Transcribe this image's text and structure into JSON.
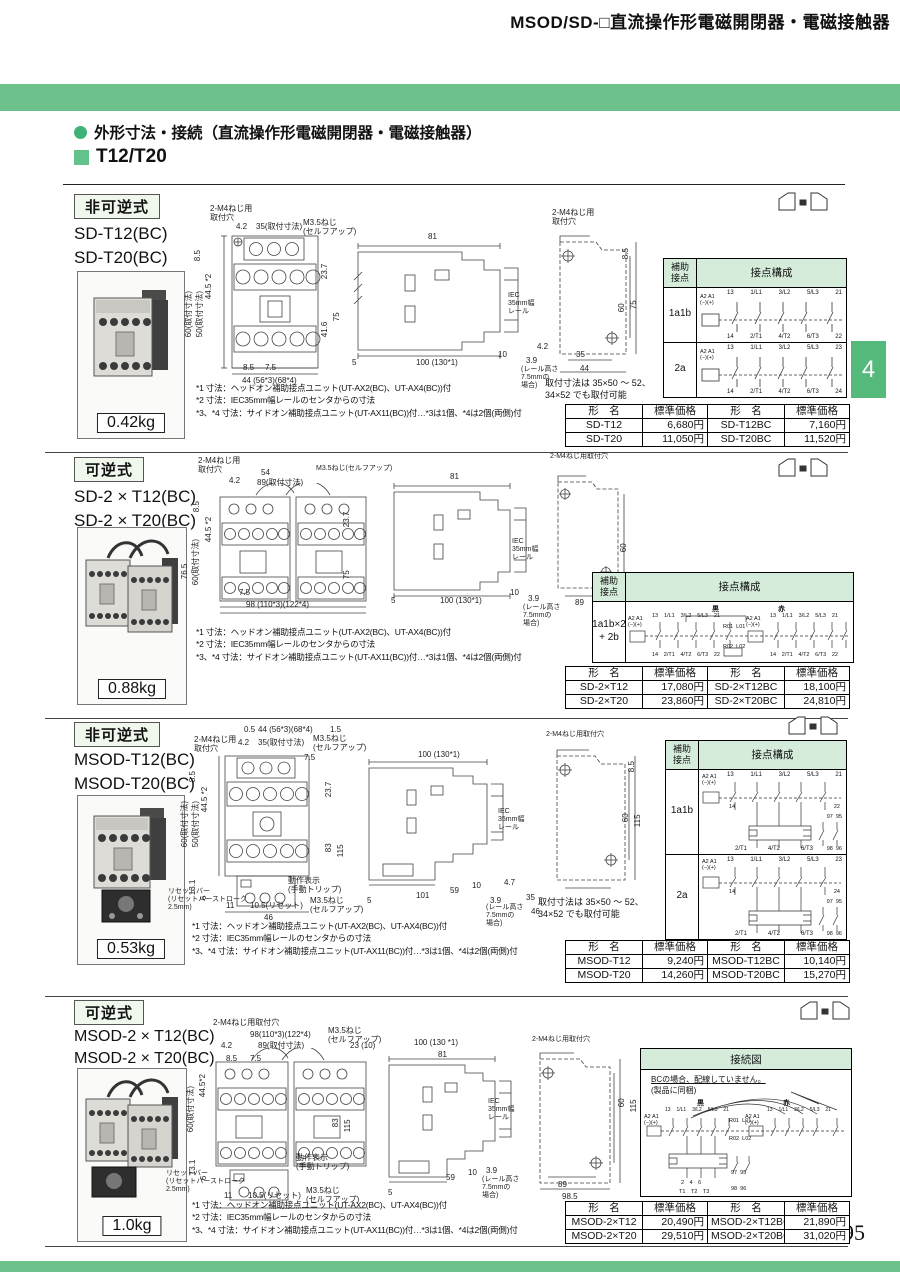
{
  "page": {
    "header_title": "MSOD/SD-□直流操作形電磁開閉器・電磁接触器",
    "section_bullet_title": "外形寸法・接続（直流操作形電磁開閉器・電磁接触器）",
    "subsection_title": "T12/T20",
    "side_tab": "4",
    "page_number": "95"
  },
  "colors": {
    "accent_green": "#6cc28a",
    "tab_green": "#54b97b",
    "bullet_green": "#3fb377",
    "table_header_green": "#d5ecdb",
    "label_box_green": "#f0f8ee"
  },
  "common": {
    "aux_header": "補助\n接点",
    "config_header": "接点構成",
    "model_col": "形　名",
    "price_col": "標準価格",
    "connection_title": "接続図"
  },
  "sections": [
    {
      "type_label": "非可逆式",
      "models": [
        "SD-T12(BC)",
        "SD-T20(BC)"
      ],
      "weight": "0.42kg",
      "notes": [
        "*1 寸法：ヘッドオン補助接点ユニット(UT-AX2(BC)、UT-AX4(BC))付",
        "*2 寸法：IEC35mm幅レールのセンタからの寸法",
        "*3、*4 寸法：サイドオン補助接点ユニット(UT-AX11(BC))付…*3は1個、*4は2個(両側)付"
      ],
      "mount_note": "取付寸法は 35×50 ～ 52、\n34×52 でも取付可能",
      "dims": {
        "m4": "2-M4ねじ用\n取付穴",
        "w42": "4.2",
        "w35": "35(取付寸法)",
        "m35": "M3.5ねじ\n(セルフアップ)",
        "h85": "8.5",
        "h445": "44.5 *2",
        "h60": "60(取付寸法)",
        "h50": "50(取付寸法)",
        "h237": "23.7",
        "h416": "41.6",
        "h75": "75",
        "b85": "8.5",
        "b75": "7.5",
        "b44": "44 (56*3)(68*4)",
        "s81": "81",
        "s5": "5",
        "s100": "100 (130*1)",
        "s10": "10",
        "s39": "3.9",
        "srail": "(レール高さ\n7.5mmの\n場合)",
        "siec": "IEC\n35mm幅\nレール",
        "s42": "4.2",
        "mm4": "2-M4ねじ用\n取付穴",
        "mh85": "8.5",
        "mh60": "60",
        "mh75": "75",
        "mw35": "35",
        "mw44": "44"
      },
      "contact_rows": [
        {
          "label": "1a1b",
          "coil": "A2 A1\n(−)(+)",
          "top": [
            "13",
            "1/L1",
            "3/L2",
            "5/L3",
            "21"
          ],
          "bottom": [
            "14",
            "2/T1",
            "4/T2",
            "6/T3",
            "22"
          ]
        },
        {
          "label": "2a",
          "coil": "A2 A1\n(−)(+)",
          "top": [
            "13",
            "1/L1",
            "3/L2",
            "5/L3",
            "23"
          ],
          "bottom": [
            "14",
            "2/T1",
            "4/T2",
            "6/T3",
            "24"
          ]
        }
      ],
      "price_rows": [
        [
          "SD-T12",
          "6,680円",
          "SD-T12BC",
          "7,160円"
        ],
        [
          "SD-T20",
          "11,050円",
          "SD-T20BC",
          "11,520円"
        ]
      ]
    },
    {
      "type_label": "可逆式",
      "models": [
        "SD-2 × T12(BC)",
        "SD-2 × T20(BC)"
      ],
      "weight": "0.88kg",
      "notes": [
        "*1 寸法：ヘッドオン補助接点ユニット(UT-AX2(BC)、UT-AX4(BC))付",
        "*2 寸法：IEC35mm幅レールのセンタからの寸法",
        "*3、*4 寸法：サイドオン補助接点ユニット(UT-AX11(BC))付…*3は1個、*4は2個(両側)付"
      ],
      "dims": {
        "m4": "2-M4ねじ用\n取付穴",
        "w42": "4.2",
        "w54": "54",
        "w89": "89(取付寸法)",
        "m35": "M3.5ねじ(セルフアップ)",
        "h85": "8.5",
        "h445": "44.5 *2",
        "h765": "76.5",
        "h60": "60(取付寸法)",
        "h237": "23.7",
        "h75": "75",
        "b75": "7.5",
        "b98": "98 (110*3)(122*4)",
        "s81": "81",
        "s5": "5",
        "s100": "100 (130*1)",
        "s10": "10",
        "s39": "3.9",
        "srail": "(レール高さ\n7.5mmの\n場合)",
        "siec": "IEC\n35mm幅\nレール",
        "mm4": "2-M4ねじ用取付穴",
        "mh60": "60",
        "mw89": "89"
      },
      "contact": {
        "label": "1a1b×2\n+ 2b",
        "groups": [
          "黒",
          "赤"
        ],
        "coil": "A2 A1\n(−)(+)",
        "top": [
          "13",
          "1/L1",
          "3/L2",
          "5/L3",
          "21"
        ],
        "bottom": [
          "14",
          "2/T1",
          "4/T2",
          "6/T3",
          "22"
        ],
        "mid_top": "R01  L01",
        "mid_bottom": "R02  L02"
      },
      "price_rows": [
        [
          "SD-2×T12",
          "17,080円",
          "SD-2×T12BC",
          "18,100円"
        ],
        [
          "SD-2×T20",
          "23,860円",
          "SD-2×T20BC",
          "24,810円"
        ]
      ]
    },
    {
      "type_label": "非可逆式",
      "models": [
        "MSOD-T12(BC)",
        "MSOD-T20(BC)"
      ],
      "weight": "0.53kg",
      "notes": [
        "*1 寸法：ヘッドオン補助接点ユニット(UT-AX2(BC)、UT-AX4(BC))付",
        "*2 寸法：IEC35mm幅レールのセンタからの寸法",
        "*3、*4 寸法：サイドオン補助接点ユニット(UT-AX11(BC))付…*3は1個、*4は2個(両側)付"
      ],
      "mount_note": "取付寸法は 35×50 ～ 52、\n34×52 でも取付可能",
      "dims": {
        "t05": "0.5",
        "t44": "44 (56*3)(68*4)",
        "t15": "1.5",
        "m4": "2-M4ねじ用\n取付穴",
        "w42": "4.2",
        "w35": "35(取付寸法)",
        "m35": "M3.5ねじ\n(セルフアップ)",
        "b75t": "7.5",
        "h85": "8.5",
        "h445": "44.5 *2",
        "h60": "60(取付寸法)",
        "h50": "50(取付寸法)",
        "h237": "23.7",
        "h83": "83",
        "h115": "115",
        "h131": "13.1",
        "h6": "6",
        "op": "動作表示\n(手動トリップ)",
        "reset": "リセットバー\n(リセットバーストローク\n2.5mm)",
        "r11": "11",
        "r105": "10.5(リセット)",
        "m35b": "M3.5ねじ\n(セルフアップ)",
        "b46": "46",
        "s100": "100 (130*1)",
        "s5": "5",
        "s101": "101",
        "s59": "59",
        "s10": "10",
        "s39": "3.9",
        "srail": "(レール高さ\n7.5mmの\n場合)",
        "siec": "IEC\n35mm幅\nレール",
        "s47": "4.7",
        "s35": "35",
        "s46": "46",
        "mm4": "2-M4ねじ用取付穴",
        "mh85": "8.5",
        "mh60": "60",
        "mh115": "115"
      },
      "contact_rows": [
        {
          "label": "1a1b",
          "coil": "A2 A1\n(−)(+)",
          "top": [
            "13",
            "1/L1",
            "3/L2",
            "5/L3",
            "21"
          ],
          "b14": "14",
          "b_end": "22",
          "ol_terms": [
            "2/T1",
            "4/T2",
            "6/T3"
          ],
          "aux_top": "97  95",
          "aux_bottom": "98  96"
        },
        {
          "label": "2a",
          "coil": "A2 A1\n(−)(+)",
          "top": [
            "13",
            "1/L1",
            "3/L2",
            "5/L3",
            "23"
          ],
          "b14": "14",
          "b_end": "24",
          "ol_terms": [
            "2/T1",
            "4/T2",
            "6/T3"
          ],
          "aux_top": "97  95",
          "aux_bottom": "98  96"
        }
      ],
      "price_rows": [
        [
          "MSOD-T12",
          "9,240円",
          "MSOD-T12BC",
          "10,140円"
        ],
        [
          "MSOD-T20",
          "14,260円",
          "MSOD-T20BC",
          "15,270円"
        ]
      ]
    },
    {
      "type_label": "可逆式",
      "models": [
        "MSOD-2 × T12(BC)",
        "MSOD-2 × T20(BC)"
      ],
      "weight": "1.0kg",
      "notes": [
        "*1 寸法：ヘッドオン補助接点ユニット(UT-AX2(BC)、UT-AX4(BC))付",
        "*2 寸法：IEC35mm幅レールのセンタからの寸法",
        "*3、*4 寸法：サイドオン補助接点ユニット(UT-AX11(BC))付…*3は1個、*4は2個(両側)付"
      ],
      "dims": {
        "mm4t": "2-M4ねじ用取付穴",
        "t98": "98(110*3)(122*4)",
        "w42": "4.2",
        "w89": "89(取付寸法)",
        "m35": "M3.5ねじ\n(セルフアップ)",
        "t2310": "23 (10)",
        "h85": "8.5",
        "b75t": "7.5",
        "h445": "44.5*2",
        "h60": "60(取付寸法)",
        "h83": "83",
        "h115": "115",
        "h131": "13.1",
        "h6": "6",
        "op": "動作表示\n(手動トリップ)",
        "reset": "リセットバー\n(リセットバーストローク\n2.5mm)",
        "r11": "11",
        "r105": "10.5(リセット)",
        "m35b": "M3.5ねじ\n(セルフアップ)",
        "s100": "100 (130 *1)",
        "s81": "81",
        "s5": "5",
        "s59": "59",
        "s10": "10",
        "s39": "3.9",
        "srail": "(レール高さ\n7.5mmの\n場合)",
        "siec": "IEC\n35mm幅\nレール",
        "mm4": "2-M4ねじ用取付穴",
        "mh60": "60",
        "mh115": "115",
        "mw89": "89",
        "mw985": "98.5"
      },
      "connection": {
        "note1": "BCの場合、配線していません。",
        "note2": "(製品に同梱)",
        "groups": [
          "黒",
          "赤"
        ],
        "coil": "A2 A1\n(−)(+)",
        "top": [
          "13",
          "1/L1",
          "3/L2",
          "5/L3",
          "21"
        ],
        "bottom": [
          "14",
          "22"
        ],
        "mid_top": "R01  L01",
        "mid_bottom": "R02  L02",
        "aux_top": "97  95",
        "aux_bottom": "98  96",
        "terms": "2　4　6",
        "terms2": "T1　T2　T3"
      },
      "price_rows": [
        [
          "MSOD-2×T12",
          "20,490円",
          "MSOD-2×T12BC",
          "21,890円"
        ],
        [
          "MSOD-2×T20",
          "29,510円",
          "MSOD-2×T20BC",
          "31,020円"
        ]
      ]
    }
  ]
}
